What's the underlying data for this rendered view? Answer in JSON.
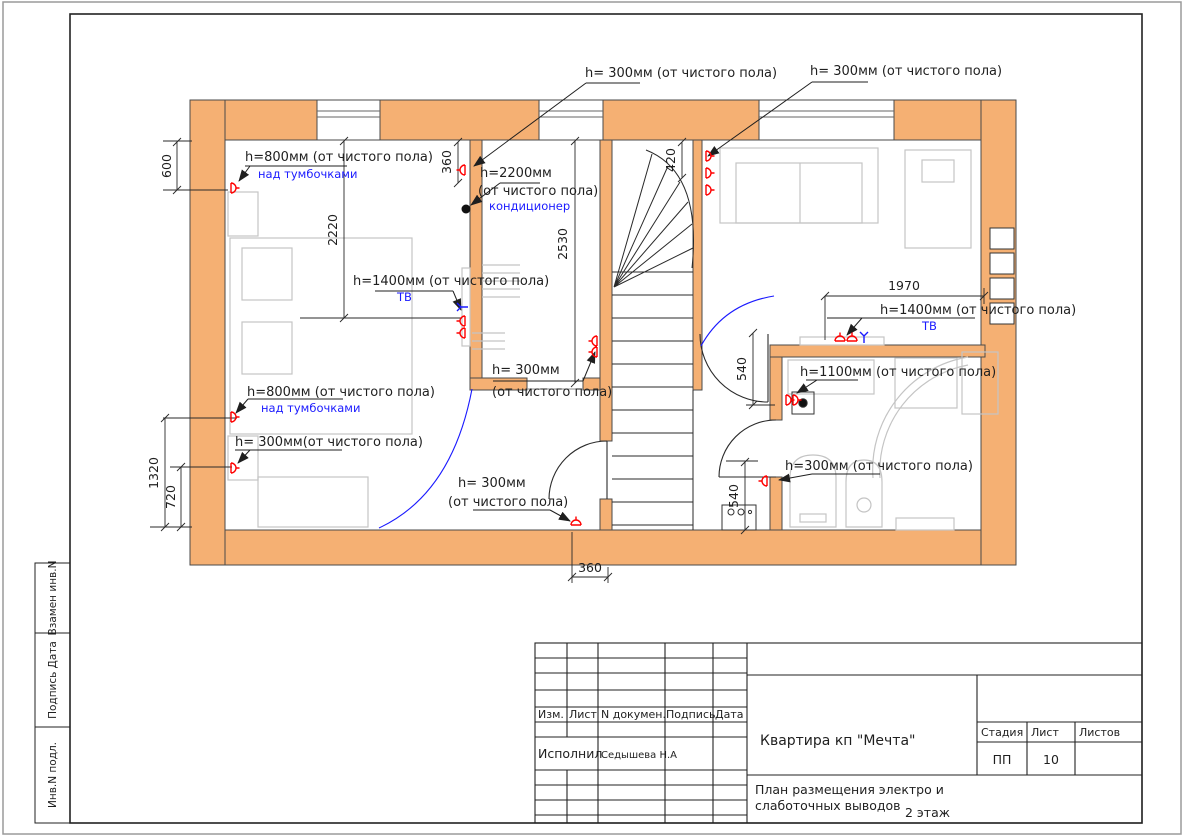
{
  "plan": {
    "a1": "h= 300мм (от чистого пола)",
    "a2": "h= 300мм (от чистого пола)",
    "a3": "h=800мм (от чистого пола)",
    "a3_sub": "над тумбочками",
    "a4_1": "h=2200мм",
    "a4_2": "(от чистого пола)",
    "a4_sub": "кондиционер",
    "a5": "h=1400мм (от чистого пола)",
    "a5_sub": "ТВ",
    "a6_1": "h= 300мм",
    "a6_2": "(от чистого пола)",
    "a7": "h=800мм (от чистого пола)",
    "a7_sub": "над тумбочками",
    "a8": "h= 300мм(от чистого пола)",
    "a9_1": "h= 300мм",
    "a9_2": "(от чистого пола)",
    "a10": "h=1400мм (от чистого пола)",
    "a10_sub": "ТВ",
    "a11": "h=1100мм (от чистого пола)",
    "a12": "h=300мм (от чистого пола)"
  },
  "dims": {
    "v600": "600",
    "v2220": "2220",
    "v360a": "360",
    "v2530": "2530",
    "v420": "420",
    "v1970": "1970",
    "v540a": "540",
    "v540b": "540",
    "v1320": "1320",
    "v720": "720",
    "v360b": "360"
  },
  "titleblock": {
    "col_izm": "Изм.",
    "col_list": "Лист",
    "col_ndoc": "N докумен.",
    "col_podpis": "Подпись",
    "col_data": "Дата",
    "executed_label": "Исполнил",
    "executed_name": "Седышева Н.А",
    "project": "Квартира кп \"Мечта\"",
    "stage_label": "Стадия",
    "sheet_label": "Лист",
    "sheets_label": "Листов",
    "stage": "ПП",
    "sheet_no": "10",
    "title_line1": "План размещения электро и",
    "title_line2": "слаботочных выводов",
    "floor": "2 этаж"
  },
  "frame_labels": {
    "vzamen": "Взамен инв.N",
    "podpis_data": "Подпись Дата",
    "inv_podl": "Инв.N подл."
  },
  "colors": {
    "wall": "#F5B073",
    "outlet": "#FF0000",
    "low_voltage": "#1A1AFF",
    "line": "#2A2A2A",
    "furniture": "#C4C4C4"
  }
}
